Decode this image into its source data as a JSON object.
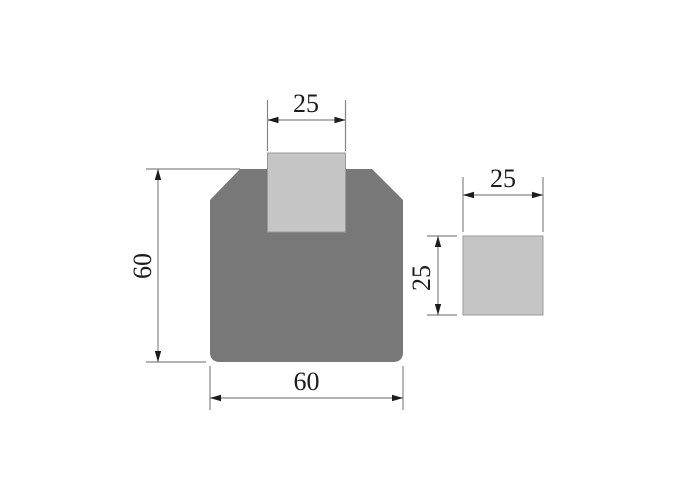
{
  "drawing": {
    "title": "die-and-insert-dimension-drawing",
    "labels": {
      "slot_width": "25",
      "body_height": "60",
      "body_width": "60",
      "insert_width": "25",
      "insert_height": "25"
    },
    "values": {
      "slot_width": 25,
      "body_height": 60,
      "body_width": 60,
      "insert_width": 25,
      "insert_height": 25
    },
    "colors": {
      "background": "#ffffff",
      "body_fill": "#787878",
      "insert_fill": "#c5c5c5",
      "line": "#858585",
      "arrow": "#1c1c1c",
      "text": "#1c1c1c"
    }
  }
}
